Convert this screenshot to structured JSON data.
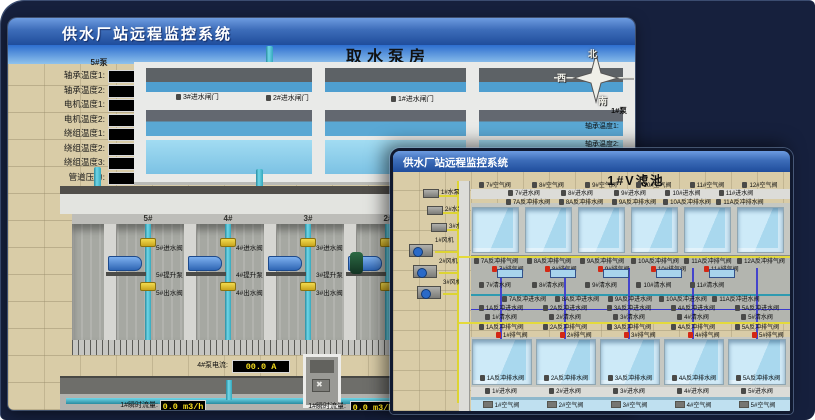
{
  "colors": {
    "background_navy": "#16203d",
    "titlebar_top": "#6d9ce0",
    "titlebar_bottom": "#1f4d9c",
    "ground_tan": "#d9cca7",
    "led_text_yellow": "#f5dc1e",
    "alarm_red": "#d42814",
    "pipe_cyan": "#6fd6e8",
    "water_blue": "#a9d8ee",
    "valve_yellow": "#f2da4e"
  },
  "back_window": {
    "title": "供水厂站远程监控系统",
    "scene_title": "取水泵房",
    "left_panel": {
      "header": "5#泵",
      "rows": [
        {
          "label": "轴承温度1:",
          "value": "100.0℃"
        },
        {
          "label": "轴承温度2:",
          "value": "100.0℃"
        },
        {
          "label": "电机温度1:",
          "value": "18.1℃"
        },
        {
          "label": "电机温度2:",
          "value": "17.9℃"
        },
        {
          "label": "绕组温度1:",
          "value": "18.0℃"
        },
        {
          "label": "绕组温度2:",
          "value": "18.1℃"
        },
        {
          "label": "绕组温度3:",
          "value": "18.1℃"
        },
        {
          "label": "管道压力:",
          "value": "0.0007MPa"
        },
        {
          "label": "多功能阀:",
          "value": "0%"
        }
      ]
    },
    "gates": [
      "3#进水闸门",
      "2#进水闸门",
      "1#进水闸门"
    ],
    "compass": {
      "north": "北",
      "west": "西",
      "south": "南"
    },
    "right_panel": {
      "header": "1#泵",
      "labels": [
        "轴承温度1:",
        "轴承温度2:"
      ]
    },
    "bays": [
      {
        "id": "5#",
        "inlet": "5#进水阀",
        "pump": "5#提升泵",
        "outlet": "5#出水阀"
      },
      {
        "id": "4#",
        "inlet": "4#进水阀",
        "pump": "4#提升泵",
        "outlet": "4#出水阀"
      },
      {
        "id": "3#",
        "inlet": "3#进水阀",
        "pump": "3#提升泵",
        "outlet": "3#出水阀"
      },
      {
        "id": "2#",
        "inlet": "",
        "pump": "",
        "outlet": ""
      }
    ],
    "current": [
      {
        "label": "4#泵电流:",
        "value": "00.0 A"
      },
      {
        "label": "2#泵电流:",
        "value": ""
      }
    ],
    "flow": [
      {
        "label": "1#瞬时流量:",
        "value": "0.0 m3/h"
      },
      {
        "label": "1#瞬时流量:",
        "value": "0.0 m3/h"
      }
    ]
  },
  "front_window": {
    "title": "供水厂站远程监控系统",
    "scene_title": "1#V滤池",
    "equipment": [
      "1#水泵",
      "2#水泵",
      "3#水泵",
      "1#风机",
      "2#风机",
      "3#风机"
    ],
    "rows": {
      "air_top": [
        "7#空气阀",
        "8#空气阀",
        "9#空气阀",
        "10#空气阀",
        "11#空气阀",
        "12#空气阀"
      ],
      "inlet_top": [
        "7#进水阀",
        "8#进水阀",
        "9#进水阀",
        "10#进水阀",
        "11#进水阀"
      ],
      "drain_top": [
        "7A反冲排水阀",
        "8A反冲排水阀",
        "9A反冲排水阀",
        "10A反冲排水阀",
        "11A反冲排水阀"
      ],
      "bw_exhaust_top": [
        "7A反冲排气阀",
        "8A反冲排气阀",
        "9A反冲排气阀",
        "10A反冲排气阀",
        "11A反冲排气阀",
        "12A反冲排气阀"
      ],
      "exhaust_top": [
        "7#排气阀",
        "8#排气阀",
        "9#排气阀",
        "10#排气阀",
        "11#排气阀"
      ],
      "clean_top": [
        "7#清水阀",
        "8#清水阀",
        "9#清水阀",
        "10#清水阀",
        "11#清水阀"
      ],
      "bw_inlet_top": [
        "7A反冲进水阀",
        "8A反冲进水阀",
        "9A反冲进水阀",
        "10A反冲进水阀",
        "11A反冲进水阀"
      ],
      "bw_inlet_low": [
        "1A反冲进水阀",
        "2A反冲进水阀",
        "3A反冲进水阀",
        "4A反冲进水阀",
        "5A反冲进水阀"
      ],
      "clean_low": [
        "1#清水阀",
        "2#清水阀",
        "3#清水阀",
        "4#清水阀",
        "5#清水阀"
      ],
      "bw_exhaust_low": [
        "1A反冲排气阀",
        "2A反冲排气阀",
        "3A反冲排气阀",
        "4A反冲排气阀",
        "5A反冲排气阀"
      ],
      "exhaust_low": [
        "1#排气阀",
        "2#排气阀",
        "3#排气阀",
        "4#排气阀",
        "5#排气阀"
      ],
      "drain_low": [
        "1A反冲排水阀",
        "2A反冲排水阀",
        "3A反冲排水阀",
        "4A反冲排水阀",
        "5A反冲排水阀"
      ],
      "inlet_low": [
        "1#进水阀",
        "2#进水阀",
        "3#进水阀",
        "4#进水阀",
        "5#进水阀"
      ],
      "air_low": [
        "1#空气阀",
        "2#空气阀",
        "3#空气阀",
        "4#空气阀",
        "5#空气阀"
      ]
    }
  }
}
